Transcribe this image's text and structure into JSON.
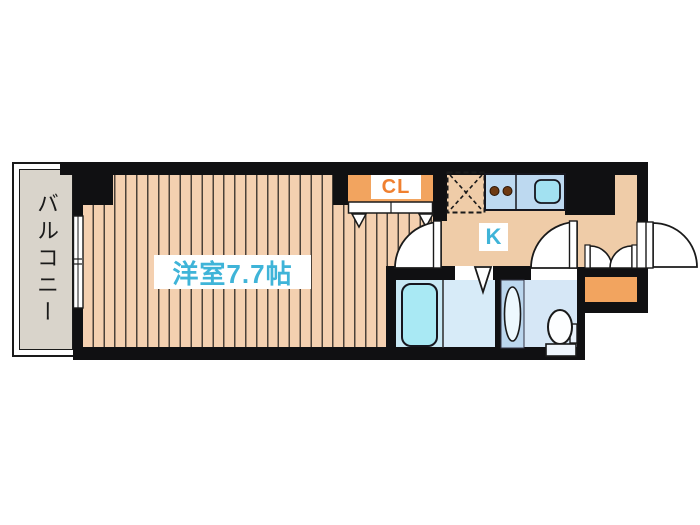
{
  "plan": {
    "balcony_label": "バルコニー",
    "room_label": "洋室7.7帖",
    "kitchen_label": "K",
    "closet_label": "CL"
  },
  "colors": {
    "wall": "#101012",
    "room_floor": "#F4D0B0",
    "floor_stripe": "#4B4138",
    "kitchen_floor": "#EFCCA8",
    "closet_orange": "#F2A45F",
    "shoe_cabinet_orange": "#F2A45F",
    "counter_blue": "#BDD9F0",
    "sink_blue": "#A2E1F1",
    "tub_cyan": "#A9E9F4",
    "bath_floor_blue": "#D7EBF8",
    "washroom_floor_blue": "#D6E7F6",
    "label_cyan": "#3FB4D8",
    "label_orange": "#F08030",
    "balcony_gray": "#D9D4CB",
    "burner_brown": "#6E3A12"
  },
  "fixtures": [
    "balcony-window",
    "closet-bifold-doors",
    "refrigerator-space",
    "stove-burners",
    "kitchen-sink",
    "room-door",
    "bath-folding-door",
    "bathtub",
    "washbasin",
    "toilet",
    "washroom-door",
    "shoe-cabinet-double-doors",
    "entrance-door"
  ]
}
